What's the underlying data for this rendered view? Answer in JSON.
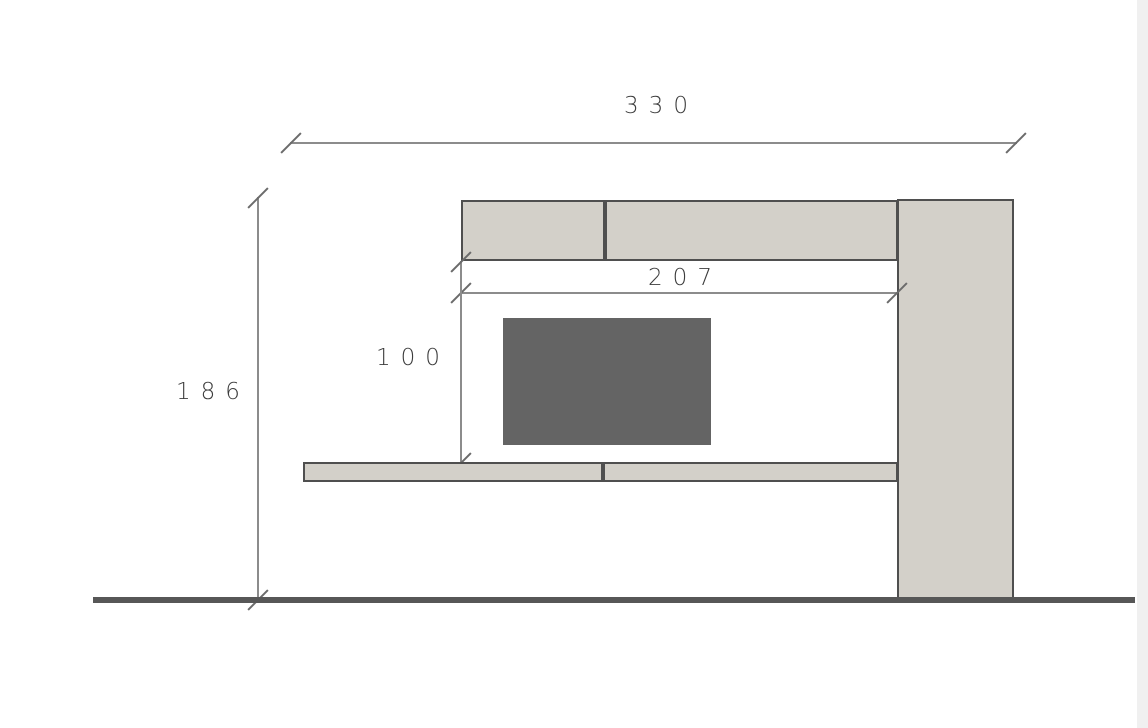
{
  "dimensions": {
    "overall_width": {
      "label": "330"
    },
    "overall_height": {
      "label": "186"
    },
    "inner_width": {
      "label": "207"
    },
    "inner_height": {
      "label": "100"
    }
  },
  "colors": {
    "cabinet_fill": "#d3d0c9",
    "cabinet_border": "#4f4f4f",
    "tv_fill": "#646464",
    "dim_line": "#8c8c8c",
    "tick": "#6b6b6b",
    "text": "#3c3c3c",
    "floor": "#575757",
    "background": "#ffffff"
  }
}
